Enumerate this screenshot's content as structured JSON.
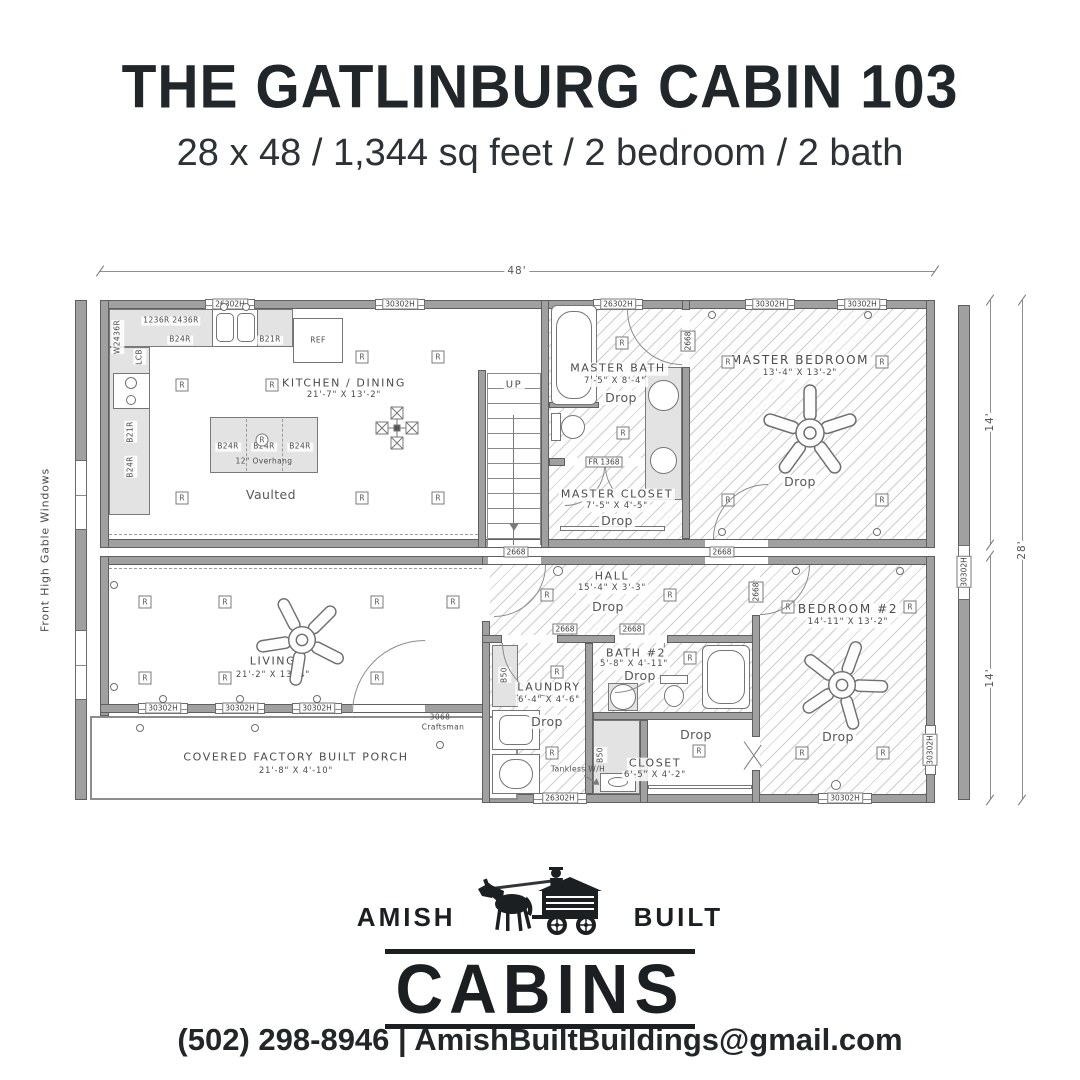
{
  "header": {
    "title": "THE GATLINBURG CABIN 103",
    "subtitle": "28 x 48 / 1,344 sq feet / 2 bedroom / 2 bath"
  },
  "plan": {
    "dims": {
      "width": "48'",
      "half_top": "14'",
      "half_bottom": "14'",
      "total": "28'"
    },
    "labels": {
      "drop": "Drop",
      "up": "UP",
      "vaulted": "Vaulted",
      "r": "R",
      "front_note": "Front High Gable Windows",
      "tankless": "Tankless W/H",
      "overhang": "12\" Overhang"
    },
    "windows": {
      "w26": "26302H",
      "w30": "30302H"
    },
    "doors": {
      "interior": "2668",
      "fr": "FR 1368",
      "front_size": "3068",
      "front_style": "Craftsman"
    },
    "cabinets": {
      "b24": "B24R",
      "b21": "B21R",
      "lcb": "LCB",
      "b50": "B50",
      "ref": "REF",
      "wall_combo": "1236R 2436R",
      "wall_side": "W2436R"
    },
    "rooms": {
      "kitchen": {
        "name": "KITCHEN / DINING",
        "dims": "21'-7\" X 13'-2\""
      },
      "master_bath": {
        "name": "MASTER BATH",
        "dims": "7'-5\" X 8'-4\""
      },
      "master_closet": {
        "name": "MASTER CLOSET",
        "dims": "7'-5\" X 4'-5\""
      },
      "master_bedroom": {
        "name": "MASTER BEDROOM",
        "dims": "13'-4\" X 13'-2\""
      },
      "hall": {
        "name": "HALL",
        "dims": "15'-4\" X 3'-3\""
      },
      "living": {
        "name": "LIVING",
        "dims": "21'-2\" X 13'-4\""
      },
      "laundry": {
        "name": "LAUNDRY",
        "dims": "6'-4\" X 4'-6\""
      },
      "bath2": {
        "name": "BATH #2",
        "dims": "5'-8\" X 4'-11\""
      },
      "closet2": {
        "name": "CLOSET",
        "dims": "6'-5\" X 4'-2\""
      },
      "bedroom2": {
        "name": "BEDROOM #2",
        "dims": "14'-11\" X 13'-2\""
      },
      "porch": {
        "name": "COVERED FACTORY BUILT PORCH",
        "dims": "21'-8\" X 4'-10\""
      }
    }
  },
  "logo": {
    "left": "AMISH",
    "right": "BUILT",
    "name": "CABINS"
  },
  "contact": {
    "phone": "(502) 298-8946",
    "separator": "|",
    "email": "AmishBuiltBuildings@gmail.com"
  }
}
